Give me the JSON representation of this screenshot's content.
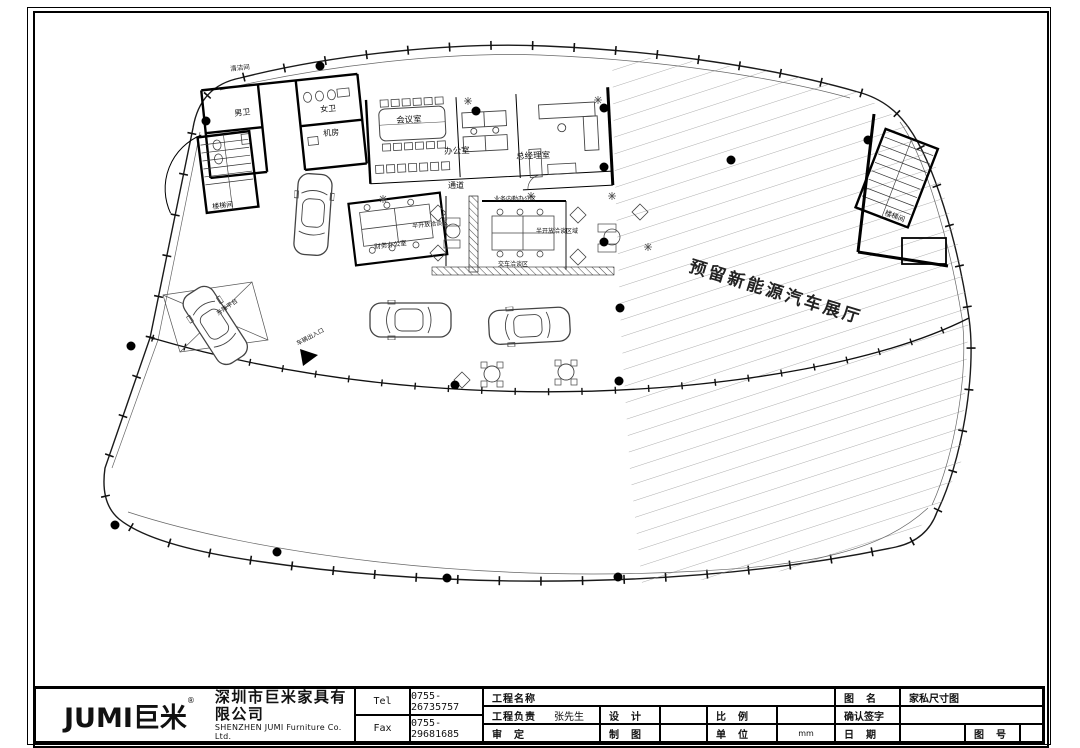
{
  "plan": {
    "reserved_area_label": "预留新能源汽车展厅",
    "rooms": {
      "cleaning": "清洁间",
      "mens_wc": "男卫",
      "womens_wc": "女卫",
      "machine_room": "机房",
      "meeting_room": "会议室",
      "office": "办公室",
      "gm_office": "总经理室",
      "corridor": "通道",
      "finance_office": "财务办公室",
      "semi_open_lounge_1": "半开放洽谈区",
      "back_office": "业务内勤办公区",
      "semi_open_lounge_2": "半开放洽谈区域",
      "delivery_lounge": "交车洽谈区",
      "stairwell_left": "楼梯间",
      "stairwell_right": "楼梯间",
      "lift_platform": "升降平台",
      "vehicle_entrance": "车辆出入口"
    }
  },
  "title_block": {
    "logo_text": "JUMI巨米",
    "logo_reg": "®",
    "company_cn": "深圳市巨米家具有限公司",
    "company_en": "SHENZHEN JUMI Furniture Co. Ltd.",
    "tel_label": "Tel",
    "tel_value": "0755-26735757",
    "fax_label": "Fax",
    "fax_value": "0755-29681685",
    "project_name_label": "工程名称",
    "project_lead_label": "工程负责",
    "project_lead_value": "张先生",
    "design_label": "设　计",
    "review_label": "审　定",
    "draft_label": "制　图",
    "scale_label": "比　例",
    "unit_label": "单　位",
    "unit_value": "mm",
    "drawing_name_label": "图　名",
    "drawing_name_value": "家私尺寸图",
    "confirm_sign_label": "确认签字",
    "date_label": "日　期",
    "drawing_no_label": "图　号"
  }
}
